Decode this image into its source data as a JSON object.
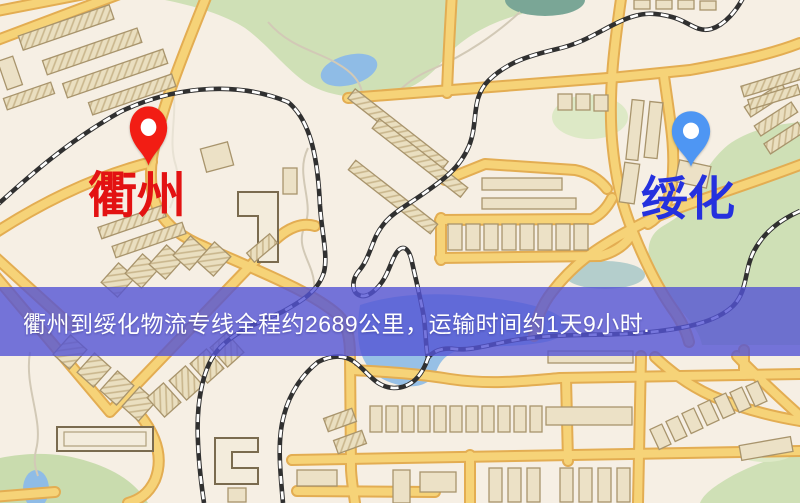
{
  "map": {
    "origin": {
      "label": "衢州",
      "label_color": "#e31212",
      "pin_icon": "red-location-pin-icon",
      "pin_color": "#f21d14"
    },
    "destination": {
      "label": "绥化",
      "label_color": "#2531de",
      "pin_icon": "blue-location-pin-icon",
      "pin_color": "#4e96f3"
    },
    "banner": {
      "text": "衢州到绥化物流专线全程约2689公里，运输时间约1天9小时.",
      "background": "#5454d5",
      "text_color": "#ffffff"
    },
    "colors": {
      "map_background": "#f6efe4",
      "road_fill": "#f6d378",
      "road_casing": "#e3ad52",
      "park_green": "#cfe0b6",
      "water_blue": "#97c0e6",
      "railway_black": "#303030",
      "building_tan": "#ece1c6"
    }
  }
}
